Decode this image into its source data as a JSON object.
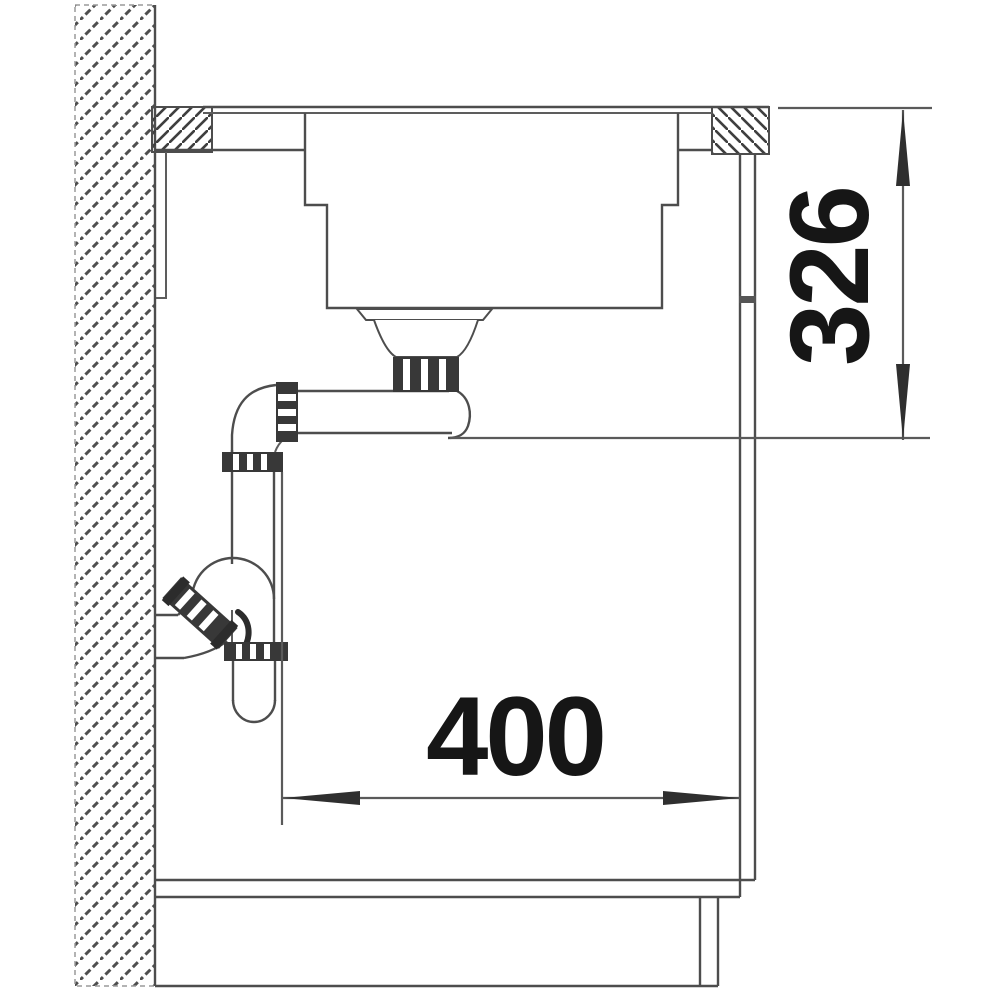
{
  "dimensions": {
    "vertical": "326",
    "horizontal": "400"
  },
  "colors": {
    "outline": "#4d4d4d",
    "dimension_line": "#5a5a5a",
    "fitting_fill": "#383838",
    "label_text": "#161616",
    "background": "#ffffff"
  }
}
